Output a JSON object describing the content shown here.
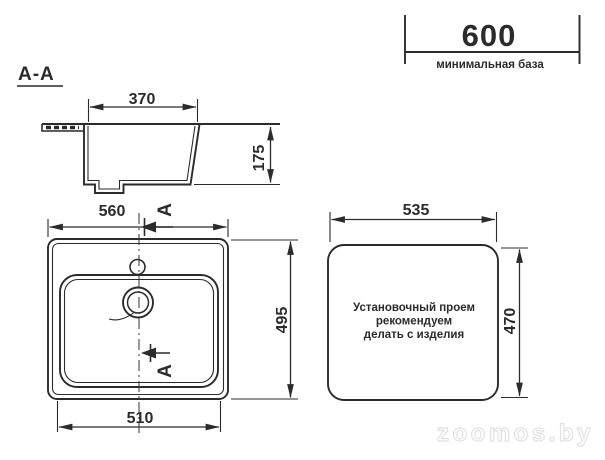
{
  "drawing": {
    "section_label": "A-A",
    "base_dim": {
      "value": "600",
      "note": "минимальная база"
    },
    "section_view": {
      "bowl_width": "370",
      "bowl_depth": "175"
    },
    "plan_view": {
      "overall_width": "560",
      "overall_depth": "495",
      "bowl_bottom_width": "510",
      "section_marker": "A"
    },
    "cutout_view": {
      "width": "535",
      "height": "470",
      "note_line1": "Установочный проем",
      "note_line2": "рекомендуем",
      "note_line3": "делать с изделия"
    }
  },
  "watermark": "zoomos.by",
  "colors": {
    "line": "#2b2b2b",
    "watermark_stroke": "#e2e2e2",
    "background": "#ffffff"
  }
}
